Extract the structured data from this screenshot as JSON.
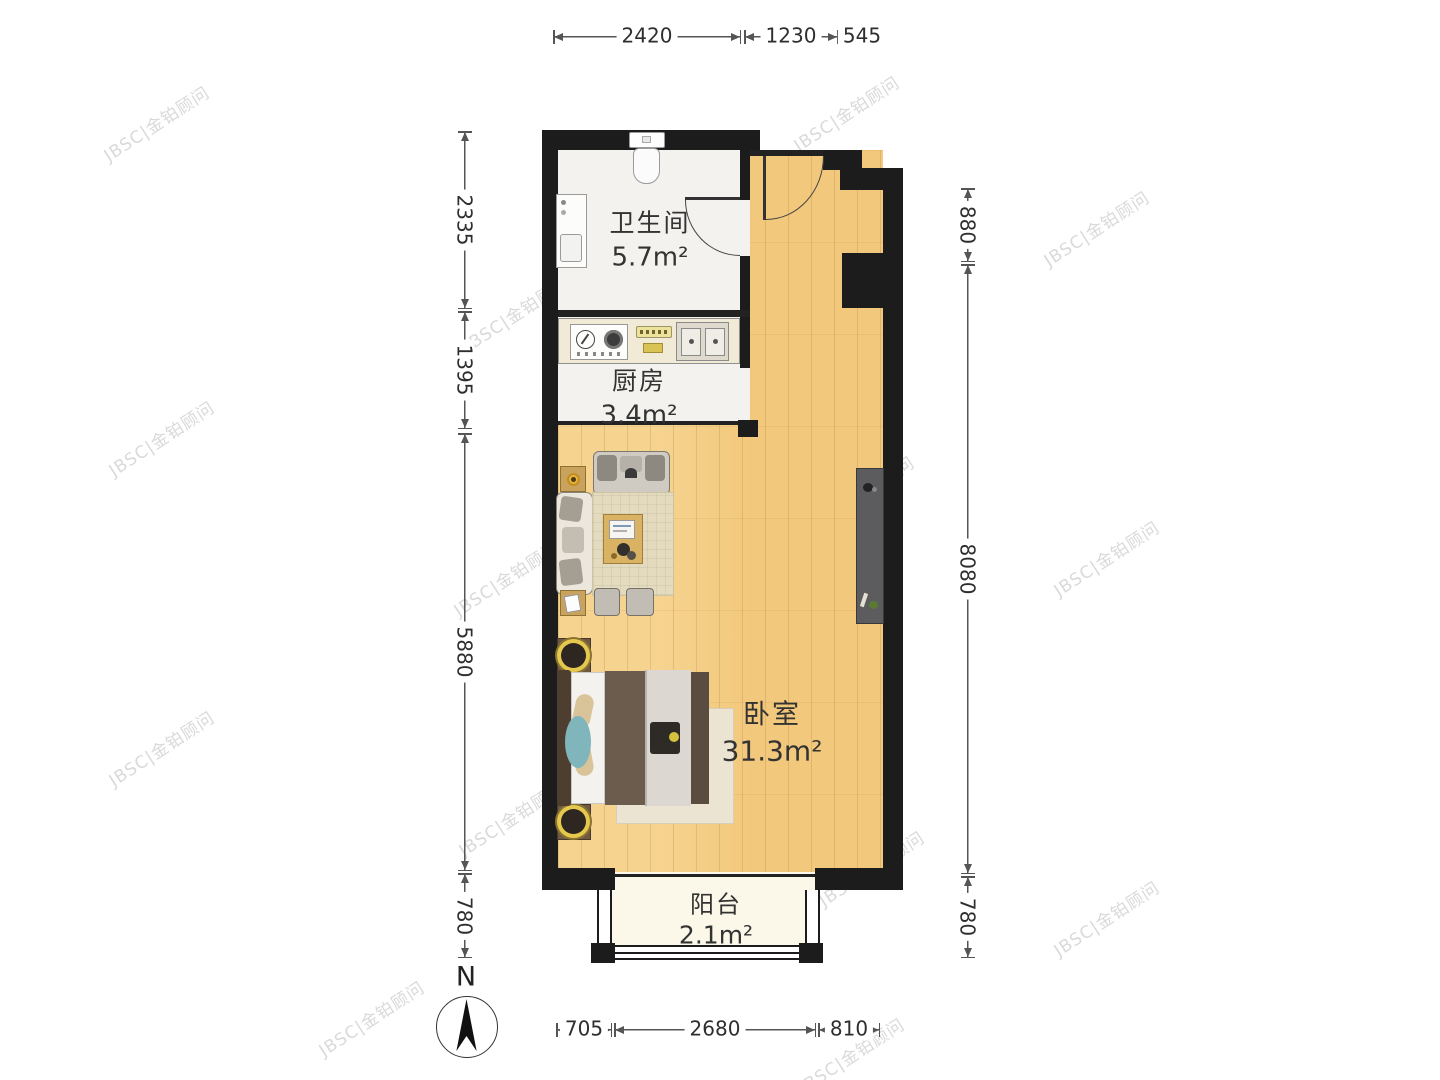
{
  "watermark": {
    "text": "JBSC|金铂顾问"
  },
  "compass": {
    "label": "N"
  },
  "rooms": [
    {
      "id": "bathroom",
      "name": "卫生间",
      "area": "5.7m²"
    },
    {
      "id": "kitchen",
      "name": "厨房",
      "area": "3.4m²"
    },
    {
      "id": "bedroom",
      "name": "卧室",
      "area": "31.3m²"
    },
    {
      "id": "balcony",
      "name": "阳台",
      "area": "2.1m²"
    }
  ],
  "dimensions": {
    "top": [
      {
        "label": "2420"
      },
      {
        "label": "1230"
      },
      {
        "label": "545"
      }
    ],
    "left": [
      {
        "label": "2335"
      },
      {
        "label": "1395"
      },
      {
        "label": "5880"
      },
      {
        "label": "780"
      }
    ],
    "right": [
      {
        "label": "880"
      },
      {
        "label": "8080"
      },
      {
        "label": "780"
      }
    ],
    "bottom": [
      {
        "label": "705"
      },
      {
        "label": "2680"
      },
      {
        "label": "810"
      }
    ]
  },
  "colors": {
    "wall": "#1c1c1c",
    "wood_floor": "#f2c87c",
    "service_floor": "#f3f2ef",
    "balcony_floor": "#fbf8e9",
    "dimension_text": "#2e2e2e"
  }
}
